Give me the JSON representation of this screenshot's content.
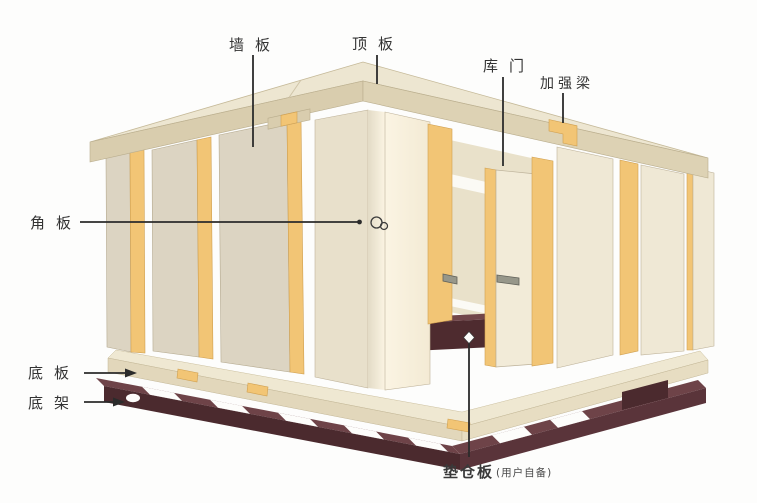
{
  "labels": {
    "wall_panel": "墙板",
    "top_panel": "顶板",
    "door": "库门",
    "reinforcement_beam": "加强梁",
    "corner_panel": "角板",
    "bottom_panel": "底板",
    "bottom_frame": "底架",
    "pallet_board": "垫仓板",
    "pallet_board_note": "(用户自备)"
  },
  "colors": {
    "background": "#FDFDFC",
    "panel_face_cream": "#DCD4C2",
    "panel_face_light": "#EFE8D5",
    "panel_edge_yellow": "#F2C575",
    "roof_top": "#EDE6D1",
    "roof_edge_tan": "#D9CDAE",
    "corner_panel_bright": "#F7F0DE",
    "floor_slab": "#EFE8D2",
    "base_frame_dark": "#4B2A2E",
    "pallet_dark": "#4E2B2F",
    "label_text": "#333333"
  },
  "icons": {
    "cam_lock": "cam-lock-icon",
    "arrowhead": "arrowhead-icon",
    "diamond_marker": "diamond-marker-icon"
  }
}
